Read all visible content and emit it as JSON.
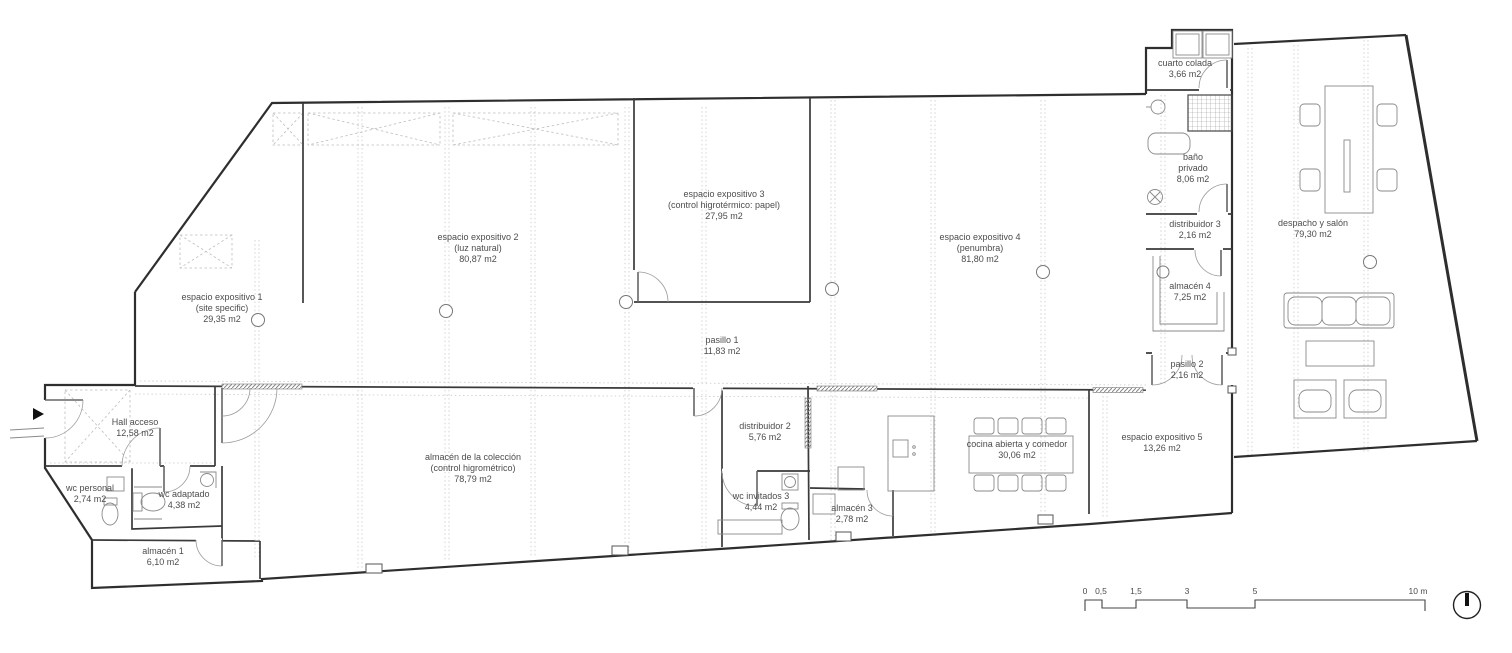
{
  "rooms": [
    {
      "name": "espacio expositivo 1",
      "sub": "(site specific)",
      "area": "29,35 m2"
    },
    {
      "name": "espacio expositivo 2",
      "sub": "(luz natural)",
      "area": "80,87 m2"
    },
    {
      "name": "espacio expositivo 3",
      "sub": "(control higrotérmico: papel)",
      "area": "27,95 m2"
    },
    {
      "name": "espacio expositivo 4",
      "sub": "(penumbra)",
      "area": "81,80 m2"
    },
    {
      "name": "pasillo 1",
      "area": "11,83 m2"
    },
    {
      "name": "cuarto colada",
      "area": "3,66 m2"
    },
    {
      "name": "baño",
      "sub": "privado",
      "area": "8,06 m2"
    },
    {
      "name": "distribuidor 3",
      "area": "2,16 m2"
    },
    {
      "name": "almacén 4",
      "area": "7,25 m2"
    },
    {
      "name": "pasillo 2",
      "area": "2,16 m2"
    },
    {
      "name": "despacho y salón",
      "area": "79,30 m2"
    },
    {
      "name": "Hall acceso",
      "area": "12,58 m2"
    },
    {
      "name": "wc personal",
      "area": "2,74 m2"
    },
    {
      "name": "wc adaptado",
      "area": "4,38 m2"
    },
    {
      "name": "almacén 1",
      "area": "6,10 m2"
    },
    {
      "name": "almacén de la colección",
      "sub": "(control higrométrico)",
      "area": "78,79 m2"
    },
    {
      "name": "distribuidor 2",
      "area": "5,76 m2"
    },
    {
      "name": "wc invitados 3",
      "area": "4,44 m2"
    },
    {
      "name": "almacén 3",
      "area": "2,78 m2"
    },
    {
      "name": "cocina abierta y comedor",
      "area": "30,06 m2"
    },
    {
      "name": "espacio expositivo 5",
      "area": "13,26 m2"
    }
  ],
  "scale_bar": {
    "labels": [
      "0",
      "0,5",
      "1,5",
      "3",
      "5",
      "10 m"
    ]
  },
  "icons": {
    "north_arrow": "north-arrow",
    "entrance_arrow": "triangle-right"
  }
}
